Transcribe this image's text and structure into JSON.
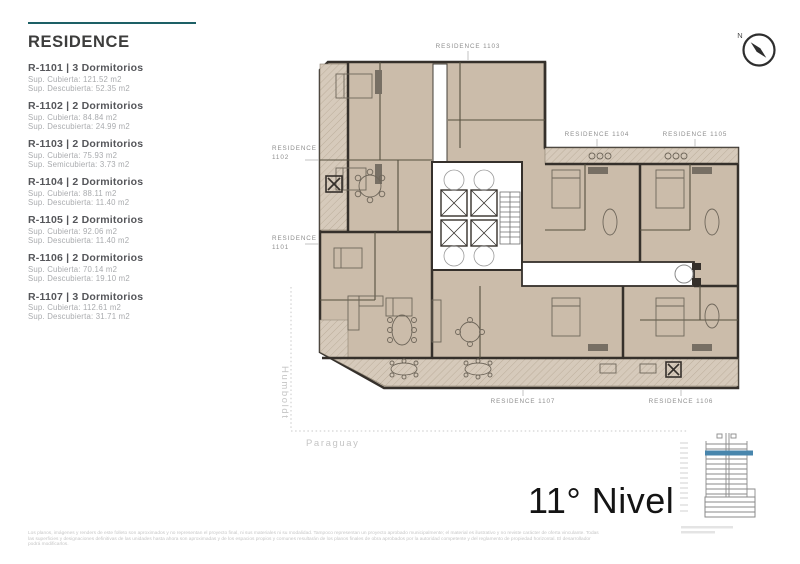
{
  "sidebar": {
    "title": "RESIDENCE",
    "units": [
      {
        "name": "R-1101 | 3 Dormitorios",
        "area1": "Sup. Cubierta: 121.52 m2",
        "area2": "Sup. Descubierta: 52.35 m2"
      },
      {
        "name": "R-1102 | 2 Dormitorios",
        "area1": "Sup. Cubierta: 84.84 m2",
        "area2": "Sup. Descubierta: 24.99 m2"
      },
      {
        "name": "R-1103 | 2 Dormitorios",
        "area1": "Sup. Cubierta: 75.93 m2",
        "area2": "Sup. Semicubierta: 3.73 m2"
      },
      {
        "name": "R-1104 | 2 Dormitorios",
        "area1": "Sup. Cubierta: 88.11 m2",
        "area2": "Sup. Descubierta: 11.40 m2"
      },
      {
        "name": "R-1105 | 2 Dormitorios",
        "area1": "Sup. Cubierta: 92.06 m2",
        "area2": "Sup. Descubierta: 11.40 m2"
      },
      {
        "name": "R-1106 | 2 Dormitorios",
        "area1": "Sup. Cubierta: 70.14 m2",
        "area2": "Sup. Descubierta: 19.10 m2"
      },
      {
        "name": "R-1107 | 3 Dormitorios",
        "area1": "Sup. Cubierta: 112.61 m2",
        "area2": "Sup. Descubierta: 31.71 m2"
      }
    ]
  },
  "plan": {
    "labels": {
      "r1103": "RESIDENCE 1103",
      "r1104": "RESIDENCE 1104",
      "r1105": "RESIDENCE 1105",
      "r1102_line1": "RESIDENCE",
      "r1102_line2": "1102",
      "r1101_line1": "RESIDENCE",
      "r1101_line2": "1101",
      "r1107": "RESIDENCE 1107",
      "r1106": "RESIDENCE 1106"
    },
    "streets": {
      "left": "Humboldt",
      "bottom": "Paraguay"
    },
    "compass": "N"
  },
  "footer": {
    "level_label": "11° Nivel",
    "disclaimer": [
      "Los planos, imágenes y renders de este folleto son aproximados y no representan el proyecto final, ni sus materiales ni su modalidad. Tampoco representan un proyecto aprobado municipalmente; el material es ilustrativo y no reviste carácter de oferta vinculante. Todas",
      "las superficies y designaciones definitivas de las unidades hasta ahora son aproximadas y de los espacios propios y comunes resultarán de los planos finales de obra aprobados por la autoridad competente y del reglamento de propiedad horizontal. El desarrollador",
      "podrá modificarlos."
    ]
  },
  "colors": {
    "accent_teal": "#1d6066",
    "elevation_highlight": "#4886ad",
    "floor_tan": "#cbbcaa",
    "balcony_tan": "#d6cabb",
    "wall_dark": "#35302b"
  }
}
